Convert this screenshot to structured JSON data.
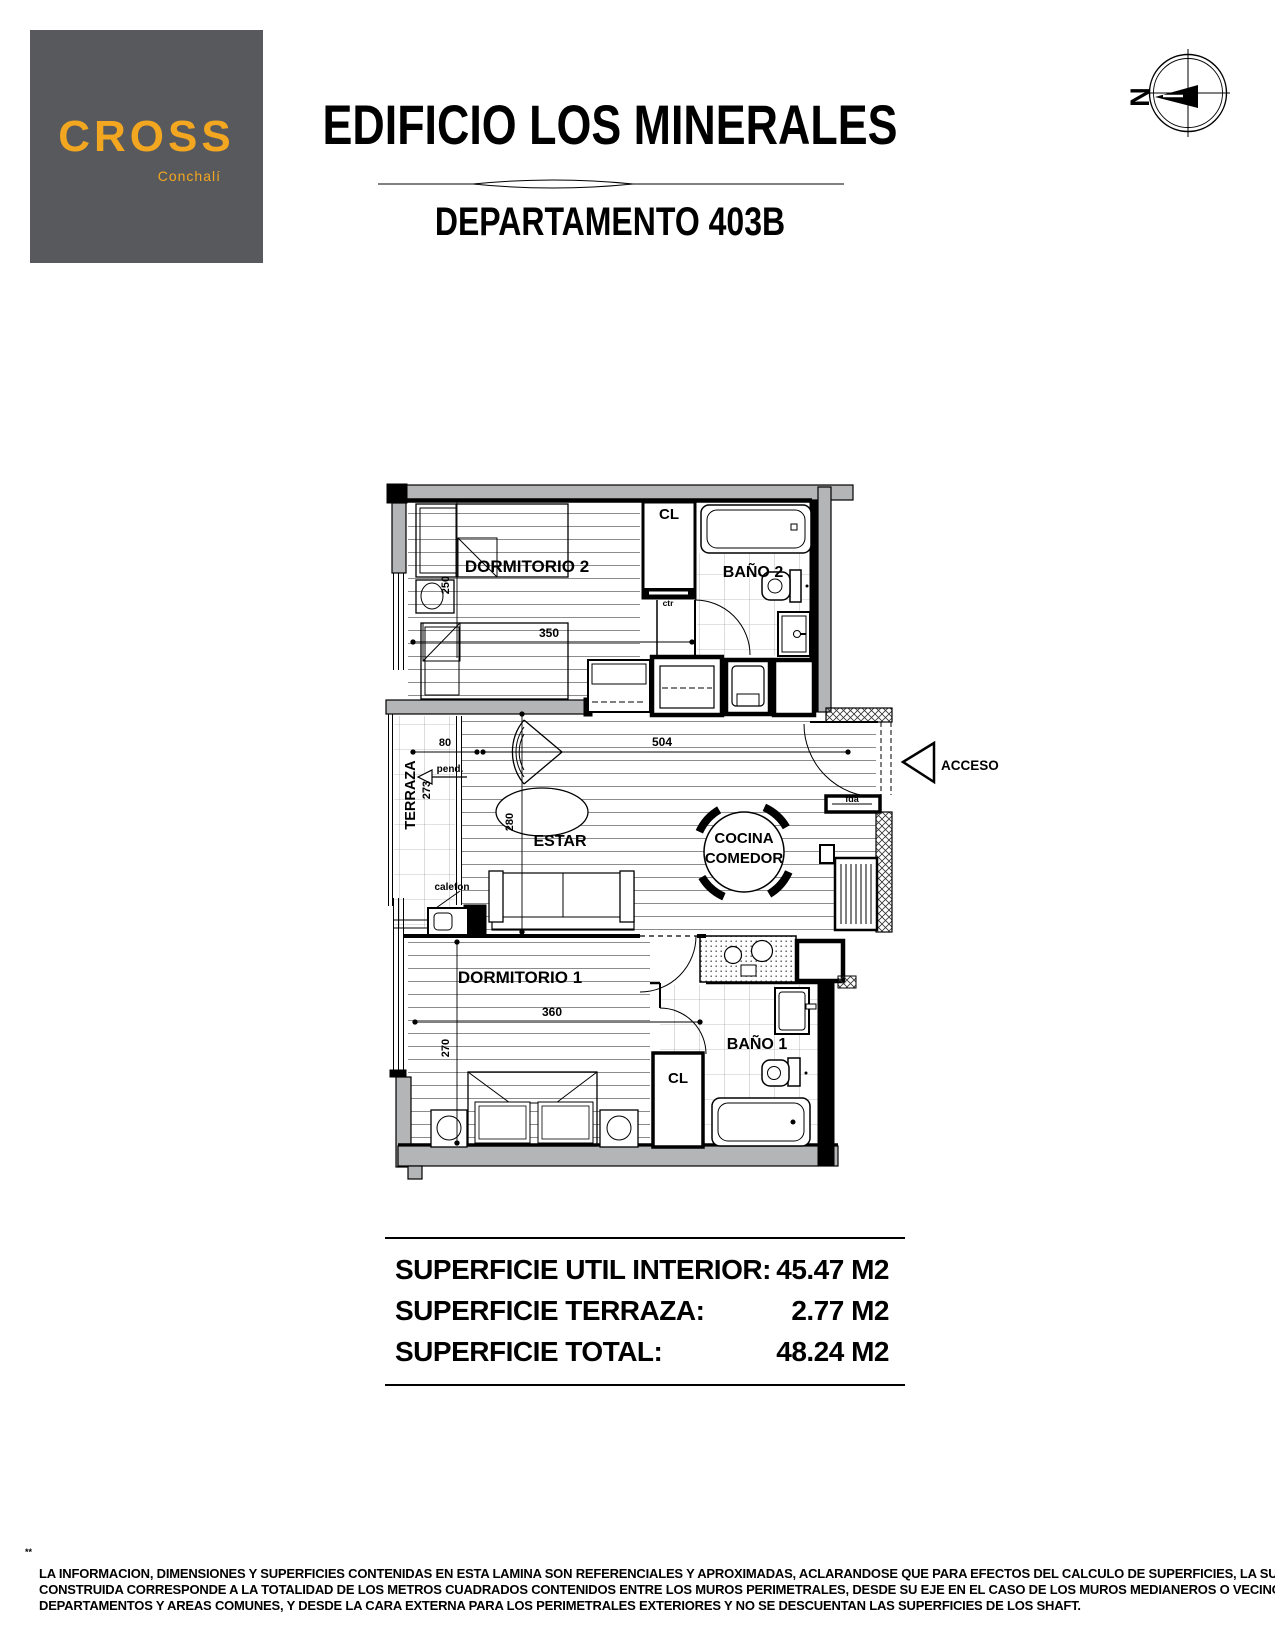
{
  "header": {
    "logo": {
      "brand": "CROSS",
      "location": "Conchalí"
    },
    "building_title": "EDIFICIO  LOS MINERALES",
    "apartment_title": "DEPARTAMENTO   403B",
    "compass_north": "N"
  },
  "colors": {
    "logo_bg": "#58595c",
    "logo_accent": "#f3a61f",
    "wall_gray": "#b4b5b7",
    "line_black": "#000000"
  },
  "plan": {
    "rooms": {
      "dorm2": "DORMITORIO 2",
      "bath2": "BAÑO 2",
      "closet_top": "CL",
      "ctr": "ctr",
      "terrace": "TERRAZA",
      "living": "ESTAR",
      "kitchen_line1": "COCINA",
      "kitchen_line2": "COMEDOR",
      "dorm1": "DORMITORIO 1",
      "bath1": "BAÑO 1",
      "closet_bottom": "CL",
      "access": "ACCESO",
      "pend": "pend.",
      "heater": "calefon",
      "door_tag": "fda"
    },
    "dims": {
      "dorm2_width": "350",
      "dorm2_depth": "250",
      "terrace_width": "80",
      "living_width": "504",
      "living_depth": "280",
      "terrace_depth": "273",
      "dorm1_width": "360",
      "dorm1_depth": "270"
    }
  },
  "summary": {
    "rows": [
      {
        "label": "SUPERFICIE UTIL INTERIOR:",
        "value": "45.47 M2"
      },
      {
        "label": "SUPERFICIE TERRAZA:",
        "value": "2.77 M2"
      },
      {
        "label": "SUPERFICIE TOTAL:",
        "value": "48.24 M2"
      }
    ]
  },
  "footnote": {
    "marker": "**",
    "lines": [
      "LA INFORMACION, DIMENSIONES Y SUPERFICIES CONTENIDAS EN ESTA LAMINA SON REFERENCIALES Y APROXIMADAS, ACLARANDOSE QUE PARA EFECTOS DEL CALCULO DE SUPERFICIES,  LA  SUPERFICIE",
      "CONSTRUIDA CORRESPONDE A LA TOTALIDAD DE LOS METROS CUADRADOS CONTENIDOS ENTRE LOS MUROS PERIMETRALES, DESDE SU EJE EN EL CASO DE LOS MUROS MEDIANEROS O VECINOS A OTROS",
      "DEPARTAMENTOS Y AREAS COMUNES, Y DESDE LA CARA EXTERNA PARA LOS PERIMETRALES EXTERIORES Y NO SE DESCUENTAN LAS SUPERFICIES DE LOS SHAFT."
    ]
  }
}
